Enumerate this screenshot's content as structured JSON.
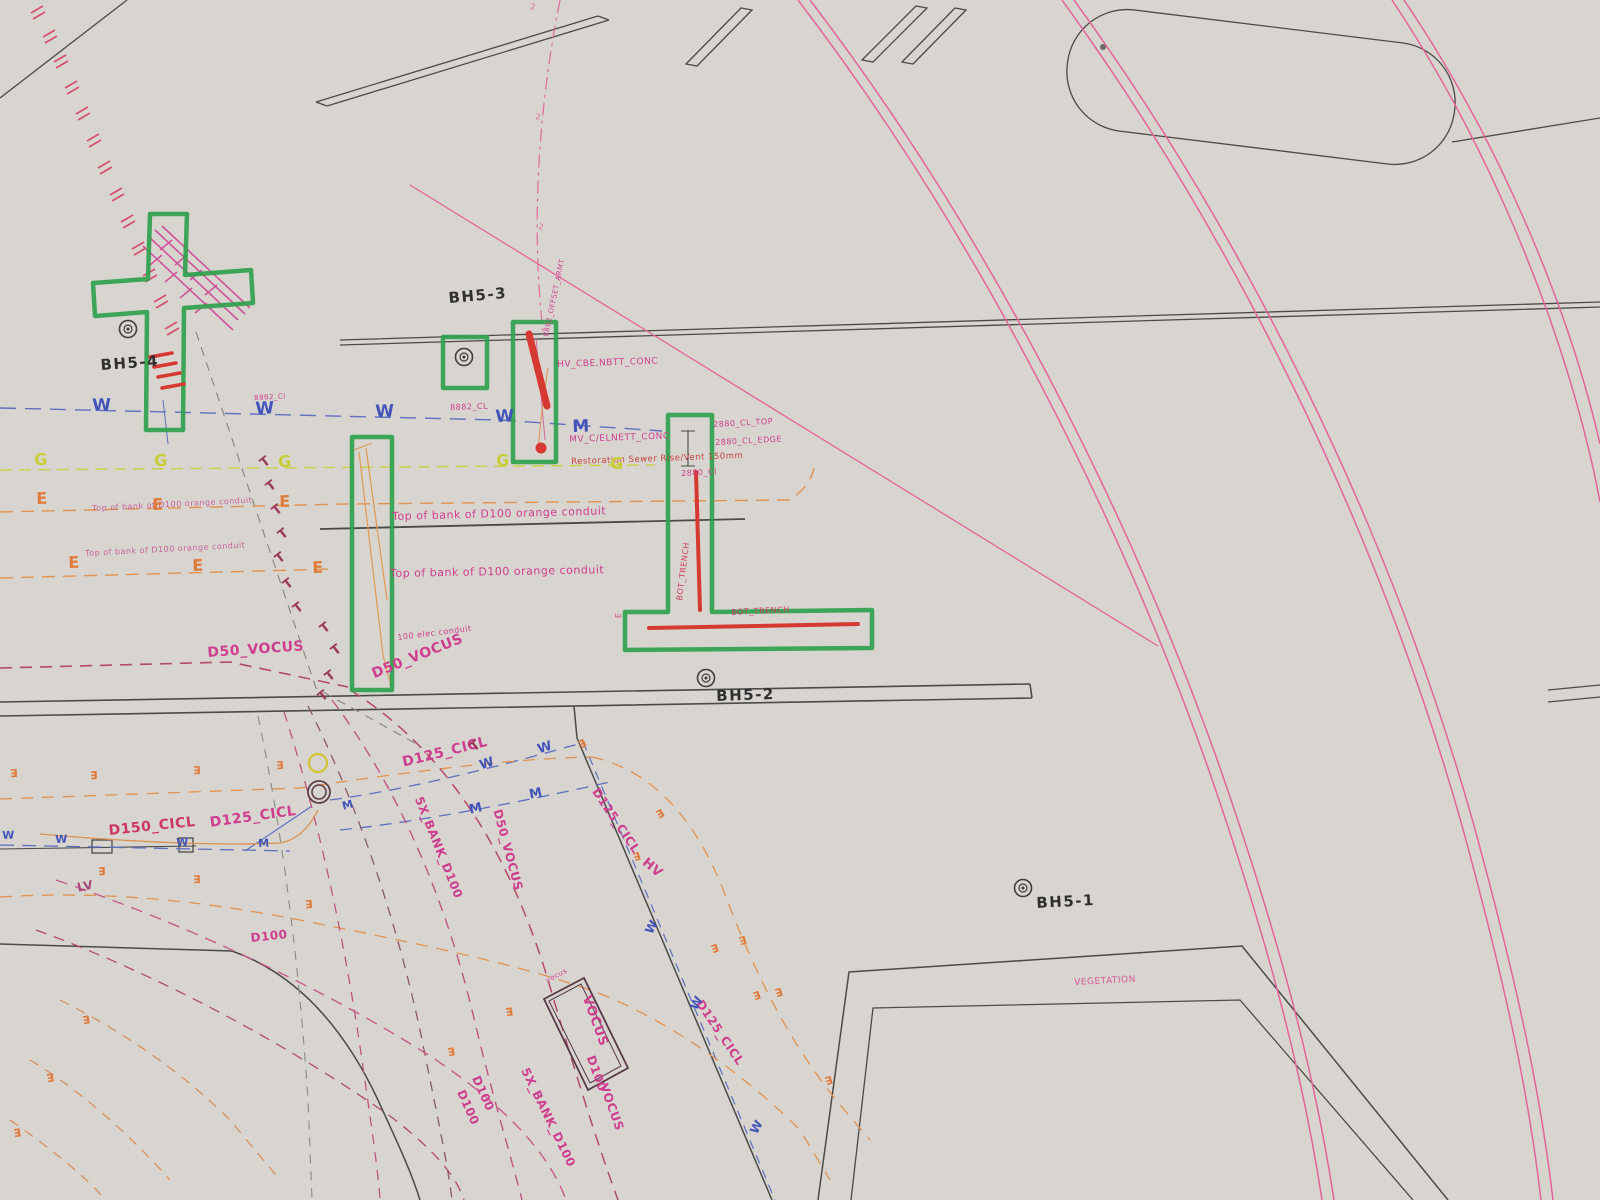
{
  "document": {
    "title": "Underground utility services plan (photographed print)"
  },
  "palette": {
    "paper": "#eeece9",
    "line_black": "#4a4a47",
    "pink_arc": "#e4639a",
    "magenta": "#cf3d8e",
    "green_highlight": "#2fa14c",
    "red_highlight": "#d63832",
    "water_blue": "#4254ba",
    "gas_yellow": "#c9cd35",
    "power_orange": "#e07a38",
    "telecom_maroon": "#9c3a5a"
  },
  "boreholes": [
    {
      "id": "BH5-4",
      "sym_x": 128,
      "sym_y": 329,
      "lbl_x": 100,
      "lbl_y": 358,
      "rot": -4
    },
    {
      "id": "BH5-3",
      "sym_x": 464,
      "sym_y": 357,
      "lbl_x": 448,
      "lbl_y": 291,
      "rot": -5
    },
    {
      "id": "BH5-2",
      "sym_x": 706,
      "sym_y": 678,
      "lbl_x": 716,
      "lbl_y": 689,
      "rot": -2
    },
    {
      "id": "BH5-1",
      "sym_x": 1023,
      "sym_y": 888,
      "lbl_x": 1036,
      "lbl_y": 896,
      "rot": -3
    }
  ],
  "labels": [
    {
      "t": "HV_CBE,NBTT_CONC",
      "x": 557,
      "y": 361,
      "r": -2,
      "s": 9
    },
    {
      "t": "MV_C/ELNETT_CONC",
      "x": 569,
      "y": 436,
      "r": -2,
      "s": 9
    },
    {
      "t": "Restoration Sewer Rise/Vent 150mm",
      "x": 571,
      "y": 458,
      "r": -2,
      "s": 8.5,
      "c": "#c6403c"
    },
    {
      "t": "8882_CL",
      "x": 450,
      "y": 404,
      "r": -2,
      "s": 8
    },
    {
      "t": "2880_CL_TOP",
      "x": 713,
      "y": 421,
      "r": -3,
      "s": 8
    },
    {
      "t": "2880_CL_EDGE",
      "x": 715,
      "y": 439,
      "r": -3,
      "s": 8
    },
    {
      "t": "2880_Cl",
      "x": 681,
      "y": 470,
      "r": -3,
      "s": 8
    },
    {
      "t": "Top of bank of D100 orange conduit",
      "x": 92,
      "y": 505,
      "r": -3,
      "s": 8,
      "c": "#c74b90",
      "o": 0.85
    },
    {
      "t": "Top of bank of D100 orange conduit",
      "x": 85,
      "y": 550,
      "r": -3,
      "s": 8,
      "c": "#c74b90",
      "o": 0.85
    },
    {
      "t": "Top of bank of D100 orange conduit",
      "x": 392,
      "y": 511,
      "r": -1.5,
      "s": 11
    },
    {
      "t": "Top of bank of D100 orange conduit",
      "x": 390,
      "y": 568,
      "r": -1,
      "s": 11
    },
    {
      "t": "100 elec conduit",
      "x": 397,
      "y": 634,
      "r": -7,
      "s": 8
    },
    {
      "t": "D50_VOCUS",
      "x": 207,
      "y": 646,
      "r": -4,
      "s": 14,
      "w": 700
    },
    {
      "t": "D50_VOCUS",
      "x": 370,
      "y": 668,
      "r": -22,
      "s": 14,
      "w": 700
    },
    {
      "t": "D125_CICL",
      "x": 401,
      "y": 756,
      "r": -14,
      "s": 14,
      "w": 700
    },
    {
      "t": "D125_CICL",
      "x": 209,
      "y": 816,
      "r": -8,
      "s": 14,
      "w": 700
    },
    {
      "t": "D150_CICL",
      "x": 108,
      "y": 824,
      "r": -6,
      "s": 14,
      "w": 700,
      "c": "#cb3762"
    },
    {
      "t": "LV",
      "x": 76,
      "y": 882,
      "r": -12,
      "s": 12,
      "w": 700,
      "c": "#a8487e"
    },
    {
      "t": "D100",
      "x": 250,
      "y": 932,
      "r": -6,
      "s": 12,
      "w": 700
    },
    {
      "t": "5X_BANK_D100",
      "x": 424,
      "y": 795,
      "r": 68,
      "s": 12,
      "w": 700
    },
    {
      "t": "D50_VOCUS",
      "x": 503,
      "y": 808,
      "r": 75,
      "s": 12,
      "w": 700
    },
    {
      "t": "HV",
      "x": 648,
      "y": 856,
      "r": 40,
      "s": 13,
      "w": 700
    },
    {
      "t": "D125_CICL",
      "x": 600,
      "y": 786,
      "r": 56,
      "s": 12,
      "w": 700
    },
    {
      "t": "D125_CICL",
      "x": 704,
      "y": 998,
      "r": 56,
      "s": 12,
      "w": 700
    },
    {
      "t": "VOCUS",
      "x": 592,
      "y": 994,
      "r": 70,
      "s": 13,
      "w": 700
    },
    {
      "t": "D100",
      "x": 596,
      "y": 1054,
      "r": 70,
      "s": 12,
      "w": 700
    },
    {
      "t": "VOCUS",
      "x": 609,
      "y": 1082,
      "r": 70,
      "s": 12,
      "w": 700
    },
    {
      "t": "D100",
      "x": 481,
      "y": 1074,
      "r": 66,
      "s": 12,
      "w": 700
    },
    {
      "t": "D100",
      "x": 466,
      "y": 1088,
      "r": 66,
      "s": 12,
      "w": 700
    },
    {
      "t": "5X_BANK_D100",
      "x": 530,
      "y": 1066,
      "r": 64,
      "s": 12,
      "w": 700
    },
    {
      "t": "VEGETATION",
      "x": 1074,
      "y": 979,
      "r": -3,
      "s": 9,
      "c": "#d8569a"
    },
    {
      "t": "vocus",
      "x": 545,
      "y": 978,
      "r": -27,
      "s": 7
    },
    {
      "t": "BOT_TRENCH",
      "x": 731,
      "y": 609,
      "r": -3,
      "s": 8,
      "c": "#cf3d62"
    },
    {
      "t": "BOT_TRENCH",
      "x": 676,
      "y": 600,
      "r": -83,
      "s": 8,
      "c": "#cf3d62"
    },
    {
      "t": "8882_OFFSET_ARMT",
      "x": 543,
      "y": 336,
      "r": -78,
      "s": 7
    },
    {
      "t": "8882_Cl",
      "x": 254,
      "y": 395,
      "r": -3,
      "s": 7
    },
    {
      "t": "2",
      "x": 531,
      "y": 3,
      "r": 8,
      "s": 8,
      "c": "#e06898"
    },
    {
      "t": "2",
      "x": 536,
      "y": 113,
      "r": 8,
      "s": 8,
      "c": "#e06898"
    },
    {
      "t": "2",
      "x": 539,
      "y": 223,
      "r": 8,
      "s": 8,
      "c": "#e06898"
    },
    {
      "t": "E",
      "x": 615,
      "y": 618,
      "r": -88,
      "s": 8,
      "c": "#cc4878"
    }
  ],
  "letter_groups": [
    {
      "name": "water-marker",
      "color": "#4254ba",
      "items": [
        [
          "W",
          92,
          398,
          -2,
          17
        ],
        [
          "W",
          255,
          401,
          -2,
          17
        ],
        [
          "W",
          375,
          404,
          -2,
          17
        ],
        [
          "W",
          495,
          409,
          -2,
          17
        ],
        [
          "M",
          572,
          419,
          -2,
          17
        ],
        [
          "W",
          2,
          830,
          -2,
          11
        ],
        [
          "W",
          55,
          834,
          -2,
          11
        ],
        [
          "W",
          176,
          837,
          -2,
          11
        ],
        [
          "M",
          258,
          838,
          -2,
          11
        ],
        [
          "M",
          341,
          801,
          -14,
          11
        ],
        [
          "W",
          478,
          760,
          -18,
          13
        ],
        [
          "W",
          536,
          744,
          -18,
          13
        ],
        [
          "M",
          468,
          804,
          -12,
          13
        ],
        [
          "M",
          528,
          789,
          -12,
          13
        ],
        [
          "W",
          643,
          930,
          -62,
          12
        ],
        [
          "W",
          688,
          1006,
          -62,
          12
        ],
        [
          "W",
          748,
          1130,
          -62,
          12
        ]
      ]
    },
    {
      "name": "gas-marker",
      "color": "#c9cd35",
      "items": [
        [
          "G",
          34,
          452,
          -1,
          16
        ],
        [
          "G",
          154,
          453,
          -1,
          16
        ],
        [
          "G",
          278,
          454,
          -1,
          16
        ],
        [
          "G",
          496,
          453,
          -1,
          16
        ],
        [
          "G",
          610,
          456,
          -1,
          16
        ]
      ]
    },
    {
      "name": "electric-marker",
      "color": "#e07a38",
      "items": [
        [
          "E",
          36,
          491,
          -2,
          16
        ],
        [
          "E",
          152,
          497,
          -2,
          16
        ],
        [
          "E",
          279,
          494,
          -2,
          16
        ],
        [
          "E",
          68,
          555,
          -2,
          16
        ],
        [
          "E",
          192,
          558,
          -2,
          16
        ],
        [
          "E",
          312,
          560,
          -2,
          16
        ],
        [
          "E",
          18,
          778,
          178,
          11
        ],
        [
          "E",
          98,
          780,
          178,
          11
        ],
        [
          "E",
          201,
          775,
          178,
          11
        ],
        [
          "E",
          284,
          770,
          178,
          11
        ],
        [
          "E",
          1,
          884,
          178,
          11
        ],
        [
          "E",
          106,
          876,
          178,
          11
        ],
        [
          "E",
          201,
          884,
          178,
          11
        ],
        [
          "E",
          313,
          909,
          178,
          11
        ],
        [
          "E",
          588,
          746,
          150,
          11
        ],
        [
          "E",
          666,
          816,
          150,
          11
        ],
        [
          "E",
          642,
          860,
          162,
          11
        ],
        [
          "E",
          748,
          944,
          162,
          11
        ],
        [
          "E",
          720,
          952,
          162,
          11
        ],
        [
          "E",
          762,
          999,
          162,
          11
        ],
        [
          "E",
          784,
          996,
          162,
          11
        ],
        [
          "E",
          834,
          1084,
          162,
          11
        ],
        [
          "E",
          91,
          1024,
          170,
          11
        ],
        [
          "E",
          55,
          1082,
          170,
          11
        ],
        [
          "E",
          22,
          1137,
          170,
          11
        ],
        [
          "E",
          514,
          1016,
          170,
          11
        ],
        [
          "E",
          456,
          1056,
          170,
          11
        ]
      ]
    },
    {
      "name": "telecom-marker",
      "color": "#9c3a5a",
      "items": [
        [
          "T",
          258,
          460,
          -38,
          13
        ],
        [
          "T",
          264,
          484,
          -38,
          13
        ],
        [
          "T",
          270,
          508,
          -38,
          13
        ],
        [
          "T",
          276,
          532,
          -38,
          13
        ],
        [
          "T",
          273,
          556,
          -38,
          13
        ],
        [
          "T",
          281,
          582,
          -38,
          13
        ],
        [
          "T",
          291,
          606,
          -38,
          13
        ],
        [
          "T",
          318,
          626,
          -38,
          13
        ],
        [
          "T",
          329,
          648,
          -38,
          13
        ],
        [
          "T",
          323,
          674,
          -38,
          13
        ],
        [
          "T",
          316,
          694,
          -38,
          13
        ],
        [
          "T",
          468,
          744,
          -38,
          13
        ]
      ]
    }
  ]
}
